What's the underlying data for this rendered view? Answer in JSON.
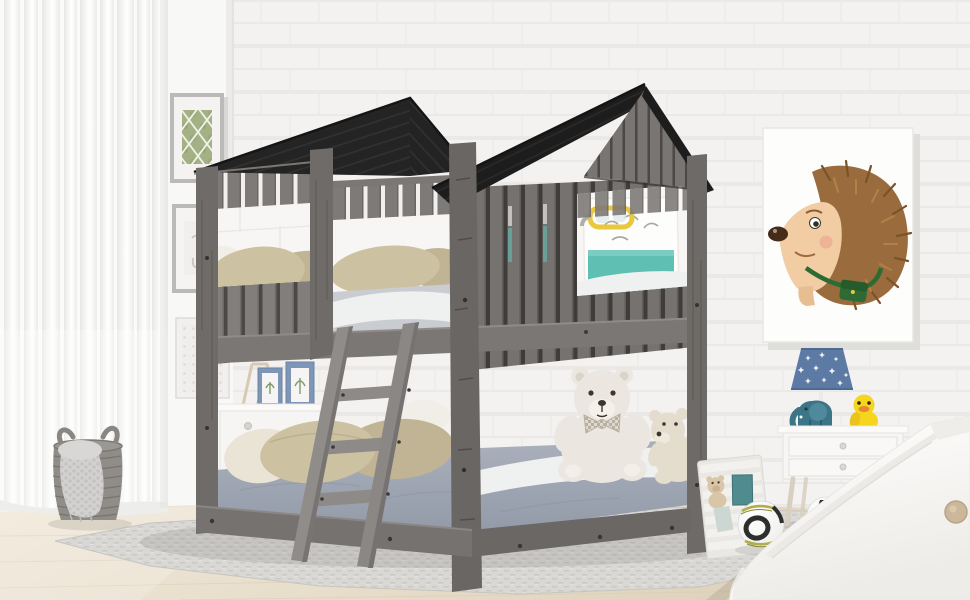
{
  "meta": {
    "type": "product-photo",
    "subject": "Kids house-frame wood bunk bed (antique gray) with dark gable roofs, ladder and guardrails, staged in a child's bedroom",
    "width_px": 970,
    "height_px": 600
  },
  "palette": {
    "wall": "#f3f2f0",
    "wall_left_plane": "#f8f8f6",
    "brick_line": "#e6e5e3",
    "curtain": "#fbfbf9",
    "curtain_fold": "#e9e9e7",
    "floor_wood": "#e9dfcb",
    "floor_line": "#d9cdb5",
    "rug_gray": "#d9d8d4",
    "rug_white": "#eceae6",
    "roof_dark": "#242424",
    "roof_darker": "#1d1d1d",
    "wood_plank": "#827e7b",
    "wood_plank_dark": "#767270",
    "wood_gap": "#4c4845",
    "wood_post": "#6f6b68",
    "wood_post_dark": "#68625f",
    "wood_rail": "#7b7774",
    "wood_rail_dark": "#6b6764",
    "ladder_wood": "#908c89",
    "window_wall": "#f7f6f4",
    "pillow_khaki": "#ccc2a2",
    "pillow_tan": "#c0b494",
    "pillow_cream": "#e9e4d6",
    "pillow_white": "#f0eee7",
    "mattress_upper": "#c9ccd1",
    "sheet_white": "#eff0f0",
    "mattress_lower": "#99a1ae",
    "bear_white": "#ebe7e0",
    "bear_cream": "#e4dccd",
    "bear_face": "#3c362e",
    "poster_white": "#fdfdfc",
    "poster_teal": "#5fbfb2",
    "goggle_yellow": "#e9c83e",
    "hedgehog_spike": "#9a6b3d",
    "hedgehog_spike_dark": "#7c5227",
    "hedgehog_face": "#f2cda4",
    "hedgehog_nose": "#462b19",
    "strap_green": "#2e6b34",
    "cheek_pink": "#eda68f",
    "lamp_blue": "#5d7aa4",
    "lamp_star": "#f4f4f2",
    "elephant_teal": "#3b7587",
    "duck_yellow": "#f6d51f",
    "beak_orange": "#e8872b",
    "nightstand_white": "#f7f6f4",
    "leg_wood": "#d9cfc0",
    "panel_white": "#efeeea",
    "ball_white": "#f7f7f5",
    "ball_black": "#2e2e2c",
    "ball_olive": "#b1ae4a",
    "slide_white": "#fbfbf9",
    "slide_knob": "#cbb79a",
    "basket_gray": "#908d89",
    "basket_line": "#6f6c68",
    "towel_gray": "#d2d1cf",
    "frame_gray": "#bbbab8",
    "art_green": "#a3b184",
    "dresser_white": "#f6f5f3",
    "frame_blue": "#7d95b6",
    "easel_wood": "#d8c9b2",
    "shadow": "rgba(60,55,50,0.12)"
  },
  "scene": {
    "objects": [
      {
        "name": "sheer-curtain-window",
        "desc": "floor-length white sheer curtain over window, left edge"
      },
      {
        "name": "white-brick-wall",
        "desc": "white painted brick wall with corner seam"
      },
      {
        "name": "wall-art-trellis",
        "desc": "gray framed green trellis/leaf print, upper left wall"
      },
      {
        "name": "wall-art-sketch",
        "desc": "gray framed faint pencil sketch, left wall"
      },
      {
        "name": "wall-art-lace-panel",
        "desc": "white carved/lace square panel, lower left wall"
      },
      {
        "name": "laundry-basket",
        "desc": "gray wicker basket with draped knit towel"
      },
      {
        "name": "kids-dresser",
        "desc": "small white dresser behind bed with easel and two blue photo frames"
      },
      {
        "name": "bunk-bed",
        "desc": "antique gray wood house bunk bed: two dark plank gable roofs, slatted walls, window cutouts, ladder"
      },
      {
        "name": "upper-bunk",
        "desc": "loft bunk with khaki pillows and white/gray mattress seen through window cutouts"
      },
      {
        "name": "wall-posters-behind-bed",
        "desc": "white kids posters with teal paint and yellow goggles doodle behind upper bunk"
      },
      {
        "name": "lower-bunk",
        "desc": "full-size floor bunk with blue-gray mattress, khaki/cream pillows, two teddy bears"
      },
      {
        "name": "ladder",
        "desc": "angled gray wood ladder with three rungs"
      },
      {
        "name": "hedgehog-poster",
        "desc": "large white poster of cartoon hedgehog with green satchel, right wall"
      },
      {
        "name": "nightstand",
        "desc": "white two-drawer nightstand with splayed wood legs"
      },
      {
        "name": "table-lamp",
        "desc": "blue star-pattern shade lamp on nightstand"
      },
      {
        "name": "elephant-toy",
        "desc": "teal elephant figurine on nightstand"
      },
      {
        "name": "duck-toy",
        "desc": "yellow duck figurine on nightstand"
      },
      {
        "name": "slat-panel",
        "desc": "whitewashed slatted board leaning on wall with mini bear and teal cards"
      },
      {
        "name": "soccer-balls",
        "desc": "two soccer balls on the floor, bottom right"
      },
      {
        "name": "slide",
        "desc": "white toddler slide entering frame from bottom-right corner"
      },
      {
        "name": "gray-rug",
        "desc": "woven gray rug under the bed over light wood floor"
      }
    ]
  }
}
